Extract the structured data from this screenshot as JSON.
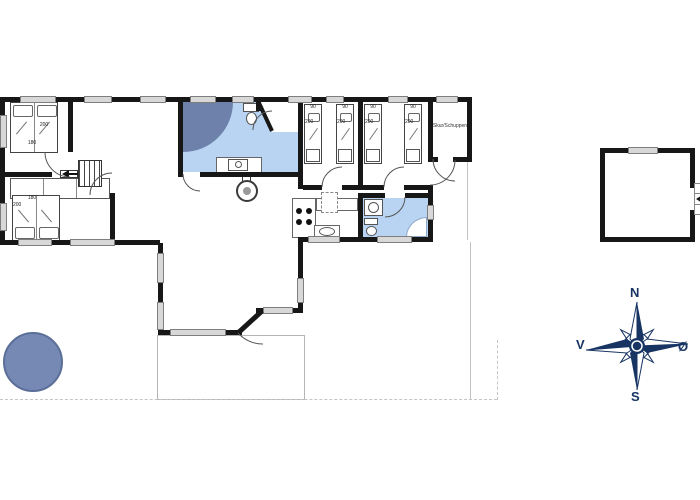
{
  "plan": {
    "shed_label": "Skur/Schuppen",
    "bedroom_tl": {
      "bed_width": "180",
      "bed_length": "200"
    },
    "bedroom_bl": {
      "bed_width": "180",
      "bed_length": "200"
    },
    "single_beds": [
      {
        "width": "90",
        "length": "200"
      },
      {
        "width": "90",
        "length": "200"
      },
      {
        "width": "90",
        "length": "200"
      },
      {
        "width": "90",
        "length": "200"
      }
    ]
  },
  "compass": {
    "north": "N",
    "east": "Ø",
    "south": "S",
    "west": "V"
  },
  "colors": {
    "wall": "#171717",
    "bath": "#b9d4f2",
    "shower": "#6e81aa",
    "garden": "#7589b4",
    "compass": "#173463",
    "window": "#d8d8d8"
  }
}
